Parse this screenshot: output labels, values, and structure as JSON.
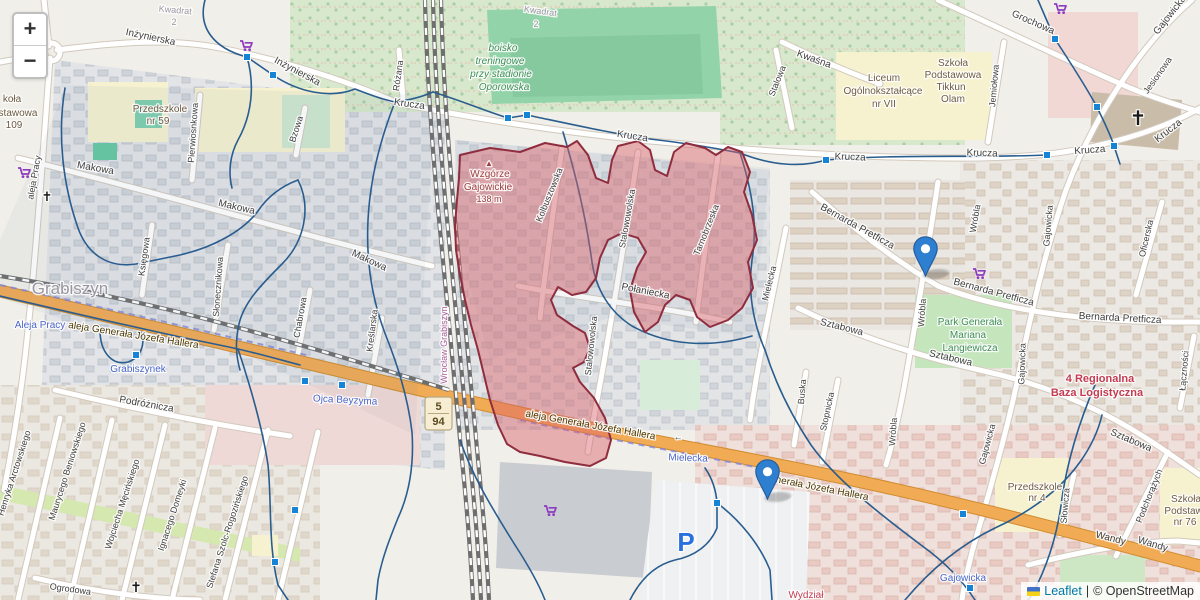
{
  "controls": {
    "zoom_in": "+",
    "zoom_out": "−"
  },
  "attribution": {
    "flag": "ukraine-flag",
    "leaflet_label": "Leaflet",
    "separator": "|",
    "osm_label": "© OpenStreetMap"
  },
  "map": {
    "palette": {
      "street": "#3f3f3f",
      "place": "#9a96a0",
      "transit": "#4a66c8",
      "school": "#6d5b43",
      "green": "#3e8e57",
      "peak": "#9f3e3e",
      "danger": "#c43b52",
      "station": "#a95f98",
      "road": "#4d3800",
      "parking": "#2a6fdf",
      "cross": "#1a1a1a"
    },
    "shield": {
      "x": 425,
      "y": 397,
      "w": 27,
      "h": 33,
      "top": "5",
      "bottom": "94",
      "bg": "#f7edd3",
      "border": "#b9a97e",
      "text": "#5a4a1f"
    },
    "carts": [
      [
        240,
        40
      ],
      [
        18,
        167
      ],
      [
        973,
        268
      ],
      [
        544,
        505
      ],
      [
        1054,
        3
      ]
    ],
    "labels": [
      {
        "t": "Kwadrat",
        "x": 175,
        "y": 13,
        "r": 5,
        "c": "place",
        "s": 9
      },
      {
        "t": "2",
        "x": 174,
        "y": 25,
        "r": 0,
        "c": "place",
        "s": 9
      },
      {
        "t": "Kwadrat",
        "x": 540,
        "y": 14,
        "r": 8,
        "c": "place",
        "s": 9
      },
      {
        "t": "2",
        "x": 536,
        "y": 27,
        "r": 0,
        "c": "place",
        "s": 9
      },
      {
        "t": "Inżynierska",
        "x": 150,
        "y": 40,
        "r": 12,
        "c": "street",
        "s": 10
      },
      {
        "t": "Inżynierska",
        "x": 296,
        "y": 74,
        "r": 28,
        "c": "street",
        "s": 10
      },
      {
        "t": "Różana",
        "x": 401,
        "y": 76,
        "r": -82,
        "c": "street",
        "s": 9
      },
      {
        "t": "Krucza",
        "x": 409,
        "y": 107,
        "r": 8,
        "c": "street",
        "s": 10
      },
      {
        "t": "Krucza",
        "x": 632,
        "y": 139,
        "r": 9,
        "c": "street",
        "s": 10
      },
      {
        "t": "Krucza",
        "x": 850,
        "y": 160,
        "r": 2,
        "c": "street",
        "s": 10
      },
      {
        "t": "Krucza",
        "x": 982,
        "y": 156,
        "r": 2,
        "c": "street",
        "s": 10
      },
      {
        "t": "Krucza",
        "x": 1090,
        "y": 153,
        "r": -4,
        "c": "street",
        "s": 10
      },
      {
        "t": "Krucza",
        "x": 1170,
        "y": 133,
        "r": -38,
        "c": "street",
        "s": 10
      },
      {
        "t": "boisko",
        "x": 503,
        "y": 51,
        "r": 0,
        "c": "green",
        "s": 10,
        "i": true
      },
      {
        "t": "treningowe",
        "x": 500,
        "y": 64,
        "r": 0,
        "c": "green",
        "s": 10,
        "i": true
      },
      {
        "t": "przy stadionie",
        "x": 501,
        "y": 77,
        "r": 0,
        "c": "green",
        "s": 10,
        "i": true
      },
      {
        "t": "Oporowska",
        "x": 504,
        "y": 90,
        "r": 0,
        "c": "green",
        "s": 10,
        "i": true
      },
      {
        "t": "koła",
        "x": 12,
        "y": 102,
        "r": 0,
        "c": "school",
        "s": 10
      },
      {
        "t": "stawowa",
        "x": 18,
        "y": 116,
        "r": 0,
        "c": "school",
        "s": 10
      },
      {
        "t": "109",
        "x": 14,
        "y": 128,
        "r": 0,
        "c": "school",
        "s": 10
      },
      {
        "t": "Przedszkole",
        "x": 160,
        "y": 112,
        "r": 0,
        "c": "school",
        "s": 10
      },
      {
        "t": "nr 59",
        "x": 158,
        "y": 124,
        "r": 0,
        "c": "school",
        "s": 10
      },
      {
        "t": "Pierwiosnkowa",
        "x": 196,
        "y": 133,
        "r": -86,
        "c": "street",
        "s": 9
      },
      {
        "t": "Bzowa",
        "x": 299,
        "y": 130,
        "r": -72,
        "c": "street",
        "s": 9
      },
      {
        "t": "Makowa",
        "x": 95,
        "y": 171,
        "r": 10,
        "c": "street",
        "s": 10
      },
      {
        "t": "Makowa",
        "x": 236,
        "y": 210,
        "r": 13,
        "c": "street",
        "s": 10
      },
      {
        "t": "Makowa",
        "x": 368,
        "y": 263,
        "r": 25,
        "c": "street",
        "s": 10
      },
      {
        "t": "Księgowa",
        "x": 147,
        "y": 257,
        "r": -82,
        "c": "street",
        "s": 9
      },
      {
        "t": "Słonecznikowa",
        "x": 221,
        "y": 287,
        "r": -86,
        "c": "street",
        "s": 9
      },
      {
        "t": "Chabrowa",
        "x": 303,
        "y": 318,
        "r": -80,
        "c": "street",
        "s": 9
      },
      {
        "t": "Kreślarska",
        "x": 375,
        "y": 331,
        "r": -83,
        "c": "street",
        "s": 9
      },
      {
        "t": "Grabiszyn",
        "x": 70,
        "y": 294,
        "r": 0,
        "c": "place",
        "s": 17
      },
      {
        "t": "Aleja Pracy",
        "x": 40,
        "y": 328,
        "r": 0,
        "c": "transit",
        "s": 10
      },
      {
        "t": "aleja Pracy",
        "x": 37,
        "y": 178,
        "r": -80,
        "c": "street",
        "s": 9
      },
      {
        "t": "aleja Generała Józefa Hallera",
        "x": 133,
        "y": 338,
        "r": 9,
        "c": "road",
        "s": 10
      },
      {
        "t": "aleja Generała Józefa Hallera",
        "x": 590,
        "y": 428,
        "r": 10,
        "c": "road",
        "s": 10
      },
      {
        "t": "Generała Józefa Hallera",
        "x": 815,
        "y": 490,
        "r": 11,
        "c": "road",
        "s": 10
      },
      {
        "t": "←",
        "x": 678,
        "y": 440,
        "r": 8,
        "c": "street",
        "s": 9
      },
      {
        "t": "Ojca Beyzyma",
        "x": 345,
        "y": 403,
        "r": 3,
        "c": "transit",
        "s": 10
      },
      {
        "t": "Grabiszynek",
        "x": 138,
        "y": 372,
        "r": 0,
        "c": "transit",
        "s": 10
      },
      {
        "t": "Podróżnicza",
        "x": 146,
        "y": 407,
        "r": 10,
        "c": "street",
        "s": 10
      },
      {
        "t": "Henryka Arctowskiego",
        "x": 17,
        "y": 474,
        "r": -72,
        "c": "street",
        "s": 9
      },
      {
        "t": "Maurycego Beniowskiego",
        "x": 70,
        "y": 472,
        "r": -72,
        "c": "street",
        "s": 9
      },
      {
        "t": "Wojciecha Męcińskiego",
        "x": 125,
        "y": 505,
        "r": -72,
        "c": "street",
        "s": 9
      },
      {
        "t": "Ignacego Domeyki",
        "x": 175,
        "y": 516,
        "r": -72,
        "c": "street",
        "s": 9
      },
      {
        "t": "Stefana Szolc-Rogozińskiego",
        "x": 230,
        "y": 533,
        "r": -72,
        "c": "street",
        "s": 9
      },
      {
        "t": "Ogrodowa",
        "x": 70,
        "y": 592,
        "r": 8,
        "c": "street",
        "s": 9
      },
      {
        "t": "▲",
        "x": 489,
        "y": 166,
        "r": 0,
        "c": "peak",
        "s": 8
      },
      {
        "t": "Wzgórze",
        "x": 490,
        "y": 177,
        "r": 0,
        "c": "peak",
        "s": 10
      },
      {
        "t": "Gajowickie",
        "x": 488,
        "y": 190,
        "r": 0,
        "c": "peak",
        "s": 10
      },
      {
        "t": "138 m",
        "x": 489,
        "y": 202,
        "r": 0,
        "c": "peak",
        "s": 9
      },
      {
        "t": "Kolbuszowska",
        "x": 552,
        "y": 196,
        "r": -68,
        "c": "street",
        "s": 9
      },
      {
        "t": "Stalowowolska",
        "x": 630,
        "y": 219,
        "r": -80,
        "c": "street",
        "s": 9
      },
      {
        "t": "Stalowowolska",
        "x": 594,
        "y": 346,
        "r": -84,
        "c": "street",
        "s": 9
      },
      {
        "t": "Tarnobrzeska",
        "x": 709,
        "y": 231,
        "r": -68,
        "c": "street",
        "s": 9
      },
      {
        "t": "Połaniecka",
        "x": 645,
        "y": 294,
        "r": 11,
        "c": "street",
        "s": 10
      },
      {
        "t": "Mielecka",
        "x": 772,
        "y": 284,
        "r": -76,
        "c": "street",
        "s": 9
      },
      {
        "t": "Mielecka",
        "x": 688,
        "y": 461,
        "r": 2,
        "c": "transit",
        "s": 10
      },
      {
        "t": "Wrocław Grabiszyn",
        "x": 447,
        "y": 345,
        "r": -90,
        "c": "station",
        "s": 9
      },
      {
        "t": "Stalowa",
        "x": 780,
        "y": 82,
        "r": -68,
        "c": "street",
        "s": 9
      },
      {
        "t": "Kwaśna",
        "x": 813,
        "y": 62,
        "r": 20,
        "c": "street",
        "s": 10
      },
      {
        "t": "Grochowa",
        "x": 1032,
        "y": 25,
        "r": 24,
        "c": "street",
        "s": 10
      },
      {
        "t": "Jemiołowa",
        "x": 997,
        "y": 86,
        "r": -85,
        "c": "street",
        "s": 9
      },
      {
        "t": "Liceum",
        "x": 884,
        "y": 81,
        "r": 0,
        "c": "school",
        "s": 10
      },
      {
        "t": "Ogólnokształcące",
        "x": 883,
        "y": 94,
        "r": 0,
        "c": "school",
        "s": 10
      },
      {
        "t": "nr VII",
        "x": 884,
        "y": 107,
        "r": 0,
        "c": "school",
        "s": 10
      },
      {
        "t": "Szkoła",
        "x": 953,
        "y": 66,
        "r": 0,
        "c": "school",
        "s": 10
      },
      {
        "t": "Podstawowa",
        "x": 953,
        "y": 78,
        "r": 0,
        "c": "school",
        "s": 10
      },
      {
        "t": "Tikkun",
        "x": 951,
        "y": 90,
        "r": 0,
        "c": "school",
        "s": 10
      },
      {
        "t": "Olam",
        "x": 953,
        "y": 102,
        "r": 0,
        "c": "school",
        "s": 10
      },
      {
        "t": "Gajowicka",
        "x": 1172,
        "y": 17,
        "r": -52,
        "c": "street",
        "s": 10
      },
      {
        "t": "Jesionowa",
        "x": 1160,
        "y": 77,
        "r": -55,
        "c": "street",
        "s": 9
      },
      {
        "t": "Oficerska",
        "x": 1149,
        "y": 239,
        "r": -77,
        "c": "street",
        "s": 9
      },
      {
        "t": "Gajowicka",
        "x": 1051,
        "y": 226,
        "r": -85,
        "c": "street",
        "s": 9
      },
      {
        "t": "Gajowicka",
        "x": 1025,
        "y": 364,
        "r": -88,
        "c": "street",
        "s": 9
      },
      {
        "t": "Gajowicka",
        "x": 990,
        "y": 445,
        "r": -75,
        "c": "street",
        "s": 9
      },
      {
        "t": "Gajowicka",
        "x": 963,
        "y": 581,
        "r": 0,
        "c": "transit",
        "s": 10
      },
      {
        "t": "Bernarda Pretficza",
        "x": 856,
        "y": 229,
        "r": 29,
        "c": "street",
        "s": 10
      },
      {
        "t": "Bernarda Pretficza",
        "x": 993,
        "y": 295,
        "r": 15,
        "c": "street",
        "s": 10
      },
      {
        "t": "Bernarda Pretficza",
        "x": 1120,
        "y": 321,
        "r": 3,
        "c": "street",
        "s": 10
      },
      {
        "t": "Wróbla",
        "x": 978,
        "y": 219,
        "r": -80,
        "c": "street",
        "s": 9
      },
      {
        "t": "Wróbla",
        "x": 925,
        "y": 313,
        "r": -86,
        "c": "street",
        "s": 9
      },
      {
        "t": "Wróbla",
        "x": 896,
        "y": 432,
        "r": -86,
        "c": "street",
        "s": 9
      },
      {
        "t": "Park Generała",
        "x": 970,
        "y": 325,
        "r": 0,
        "c": "green",
        "s": 10
      },
      {
        "t": "Mariana",
        "x": 968,
        "y": 338,
        "r": 0,
        "c": "green",
        "s": 10
      },
      {
        "t": "Langiewicza",
        "x": 970,
        "y": 351,
        "r": 0,
        "c": "green",
        "s": 10
      },
      {
        "t": "Sztabowa",
        "x": 841,
        "y": 330,
        "r": 14,
        "c": "street",
        "s": 10
      },
      {
        "t": "Sztabowa",
        "x": 950,
        "y": 361,
        "r": 13,
        "c": "street",
        "s": 10
      },
      {
        "t": "Sztabowa",
        "x": 1130,
        "y": 443,
        "r": 23,
        "c": "street",
        "s": 10
      },
      {
        "t": "4 Regionalna",
        "x": 1100,
        "y": 382,
        "r": 0,
        "c": "danger",
        "s": 11,
        "b": true
      },
      {
        "t": "Baza Logistyczna",
        "x": 1097,
        "y": 396,
        "r": 0,
        "c": "danger",
        "s": 11,
        "b": true
      },
      {
        "t": "Buska",
        "x": 805,
        "y": 392,
        "r": -85,
        "c": "street",
        "s": 9
      },
      {
        "t": "Stopnicka",
        "x": 830,
        "y": 412,
        "r": -78,
        "c": "street",
        "s": 9
      },
      {
        "t": "Łączności",
        "x": 1187,
        "y": 371,
        "r": -85,
        "c": "street",
        "s": 9
      },
      {
        "t": "Przedszkole",
        "x": 1035,
        "y": 490,
        "r": 0,
        "c": "school",
        "s": 10
      },
      {
        "t": "nr 4",
        "x": 1037,
        "y": 501,
        "r": 0,
        "c": "school",
        "s": 10
      },
      {
        "t": "Słowicza",
        "x": 1068,
        "y": 506,
        "r": -85,
        "c": "street",
        "s": 9
      },
      {
        "t": "Podchorążych",
        "x": 1152,
        "y": 497,
        "r": -68,
        "c": "street",
        "s": 9
      },
      {
        "t": "Szkoła",
        "x": 1186,
        "y": 502,
        "r": 0,
        "c": "school",
        "s": 10
      },
      {
        "t": "Podstawow",
        "x": 1190,
        "y": 514,
        "r": 0,
        "c": "school",
        "s": 10
      },
      {
        "t": "nr 76",
        "x": 1185,
        "y": 525,
        "r": 0,
        "c": "school",
        "s": 10
      },
      {
        "t": "Wandy",
        "x": 1110,
        "y": 541,
        "r": 14,
        "c": "street",
        "s": 10
      },
      {
        "t": "Wandy",
        "x": 1152,
        "y": 547,
        "r": 17,
        "c": "street",
        "s": 10
      },
      {
        "t": "Wydział",
        "x": 806,
        "y": 598,
        "r": 0,
        "c": "danger",
        "s": 10
      },
      {
        "t": "P",
        "x": 686,
        "y": 551,
        "r": 0,
        "c": "parking",
        "s": 26,
        "b": true
      },
      {
        "t": "✝",
        "x": 47,
        "y": 201,
        "r": 0,
        "c": "cross",
        "s": 13
      },
      {
        "t": "✝",
        "x": 1138,
        "y": 125,
        "r": 0,
        "c": "cross",
        "s": 20
      },
      {
        "t": "✝",
        "x": 136,
        "y": 592,
        "r": 0,
        "c": "cross",
        "s": 14
      }
    ]
  },
  "overlays": {
    "wash_fill": "rgba(100,125,155,0.07)",
    "washes": [
      "M60,85 L435,95 L415,435 L240,352 L100,332 L0,298 L0,240 L65,90 Z",
      "M455,140 L770,168 L752,336 L608,318 L490,360 L460,250 Z"
    ],
    "blue_stroke": "#2a5d8f",
    "blue_paths": [
      "M205,0 C198,26 212,48 247,57 L273,75 C298,92 330,99 355,89 C368,94 381,99 395,102 C410,100 424,96 433,92",
      "M433,92 C465,102 488,112 508,118 L527,115 C570,124 610,133 650,139 C685,143 715,148 740,153",
      "M740,153 C770,165 800,168 826,160 C890,154 980,158 1047,155",
      "M1038,0 C1044,14 1050,28 1055,39 C1070,62 1085,85 1097,107 C1103,120 1110,133 1114,146 L1120,164",
      "M740,153 C752,190 758,225 752,260 C748,290 752,320 765,350 C776,385 791,415 811,445 C836,480 881,515 921,545 C946,563 962,580 975,600",
      "M65,88 C57,135 63,185 78,228 C88,256 110,268 136,264 L180,255 C214,247 243,231 258,211 C268,196 282,186 298,180",
      "M298,180 C312,208 304,242 282,264 C262,284 244,302 239,324 C235,342 236,356 240,370",
      "M0,296 C60,310 120,324 180,337 C200,341 220,345 238,349 C260,354 281,360 300,365",
      "M100,330 C100,352 112,366 128,362 C140,358 146,345 141,332",
      "M238,349 C250,385 262,425 268,465 C272,505 268,545 278,585 L288,600",
      "M563,132 C576,175 586,218 592,262 C596,290 610,312 632,326 C668,346 710,348 752,336",
      "M395,102 C380,140 370,180 368,220 C366,260 372,300 386,336 C398,366 408,398 412,432 C414,462 410,492 398,518 C390,538 382,558 378,580 L376,600",
      "M460,440 C472,475 490,505 515,545 C528,565 538,582 545,600",
      "M630,600 C640,580 655,565 675,560 C695,556 710,545 717,528 L717,503 C716,490 712,478 705,468",
      "M717,503 C740,520 760,545 770,570 L772,600",
      "M1095,385 C1080,420 1068,458 1062,498 C1058,532 1048,565 1032,595 L1028,600",
      "M905,600 C930,570 960,545 995,528 C1030,512 1060,490 1080,462 C1090,448 1098,432 1102,415",
      "M247,57 C255,85 252,115 238,140 C230,155 228,172 232,188"
    ],
    "red_polygon": {
      "stroke": "#8f2d3e",
      "fill": "#d95f69",
      "fill_opacity": 0.45,
      "path": "M460,155 L490,148 L520,152 L545,143 L567,147 L577,141 L588,155 L596,178 L608,183 L612,160 L618,146 L638,141 L650,150 L655,170 L667,176 L674,152 L686,143 L705,148 L716,155 L728,147 L742,152 L750,172 L744,192 L752,215 L757,240 L748,262 L753,288 L742,308 L728,320 L710,327 L697,317 L690,300 L676,295 L665,305 L658,322 L645,332 L634,312 L630,290 L637,268 L646,252 L638,238 L622,233 L608,240 L600,258 L596,278 L586,292 L572,295 L558,287 L551,300 L557,315 L573,326 L585,333 L590,348 L584,362 L573,368 L580,382 L594,398 L605,418 L611,440 L606,458 L590,466 L565,462 L540,456 L520,452 L507,444 L498,425 L490,400 L484,375 L478,350 L471,325 L465,300 L460,275 L456,250 L455,225 L457,200 L459,178 Z"
    },
    "vertex_fill": "#1583d6",
    "vertices": [
      [
        247,
        57
      ],
      [
        273,
        75
      ],
      [
        508,
        118
      ],
      [
        527,
        115
      ],
      [
        826,
        160
      ],
      [
        1055,
        39
      ],
      [
        1097,
        107
      ],
      [
        1114,
        146
      ],
      [
        1047,
        155
      ],
      [
        305,
        381
      ],
      [
        342,
        385
      ],
      [
        295,
        510
      ],
      [
        275,
        562
      ],
      [
        963,
        514
      ],
      [
        970,
        588
      ],
      [
        717,
        503
      ],
      [
        136,
        355
      ]
    ],
    "marker_fill": "#2f7fd1",
    "marker_stroke": "#245d9e",
    "markers": [
      {
        "x": 925,
        "y": 277
      },
      {
        "x": 767,
        "y": 500
      }
    ]
  }
}
